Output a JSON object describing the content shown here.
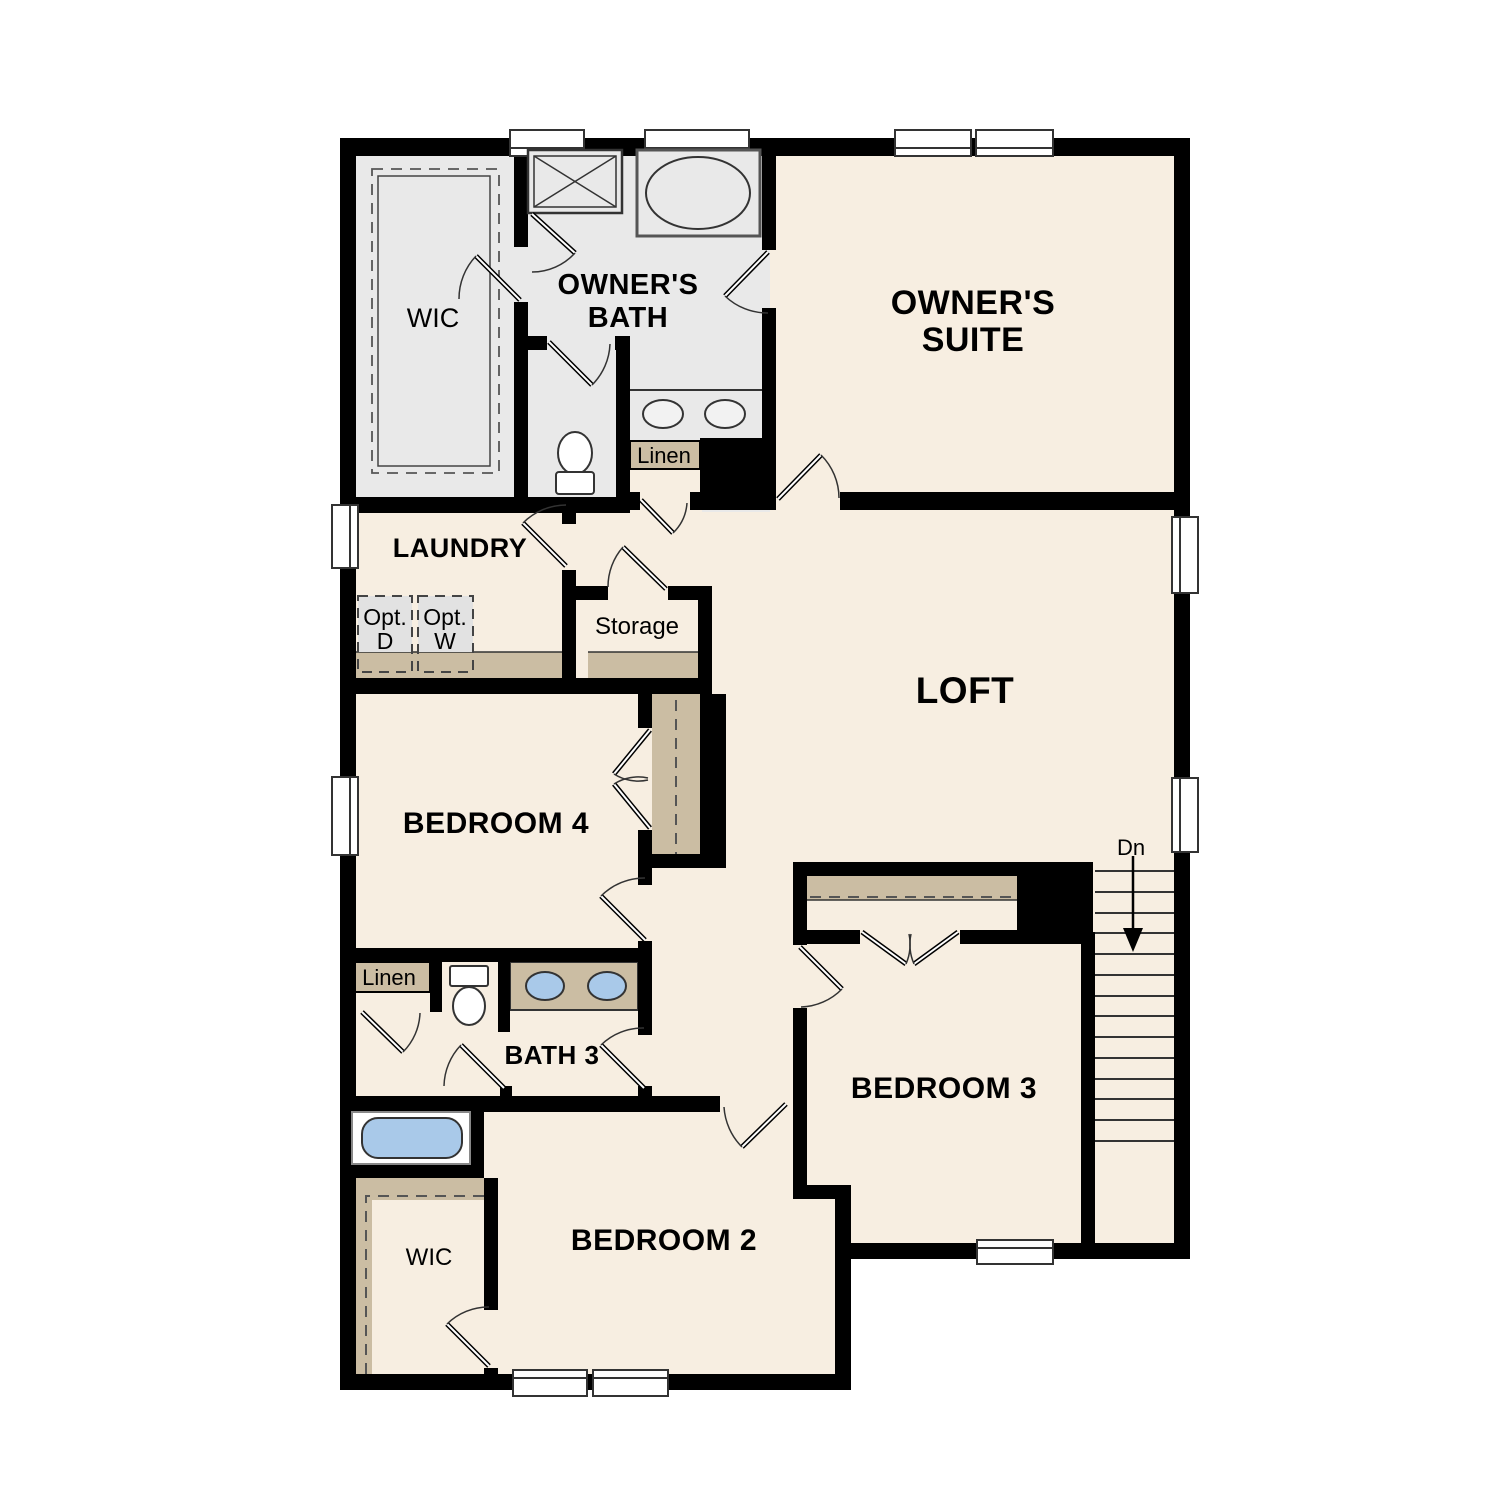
{
  "plan": {
    "title": "Second floor residential floor plan",
    "colors": {
      "wall": "#000000",
      "floor_cream": "#f7eee1",
      "floor_gray": "#e9e9e9",
      "shelf_tan": "#cbbda3",
      "fixture_blue": "#a9c9e9",
      "outline": "#333333"
    },
    "rooms": {
      "owners_suite": {
        "label_line1": "OWNER'S",
        "label_line2": "SUITE"
      },
      "owners_bath": {
        "label_line1": "OWNER'S",
        "label_line2": "BATH"
      },
      "wic_upper": {
        "label": "WIC"
      },
      "laundry": {
        "label": "LAUNDRY",
        "opt_dryer_line1": "Opt.",
        "opt_dryer_line2": "D",
        "opt_washer_line1": "Opt.",
        "opt_washer_line2": "W"
      },
      "storage": {
        "label": "Storage"
      },
      "linen_upper": {
        "label": "Linen"
      },
      "loft": {
        "label": "LOFT"
      },
      "bedroom4": {
        "label": "BEDROOM 4"
      },
      "linen_lower": {
        "label": "Linen"
      },
      "bath3": {
        "label": "BATH 3"
      },
      "bedroom3": {
        "label": "BEDROOM 3"
      },
      "bedroom2": {
        "label": "BEDROOM 2"
      },
      "wic_lower": {
        "label": "WIC"
      },
      "stairs": {
        "label": "Dn"
      }
    }
  }
}
